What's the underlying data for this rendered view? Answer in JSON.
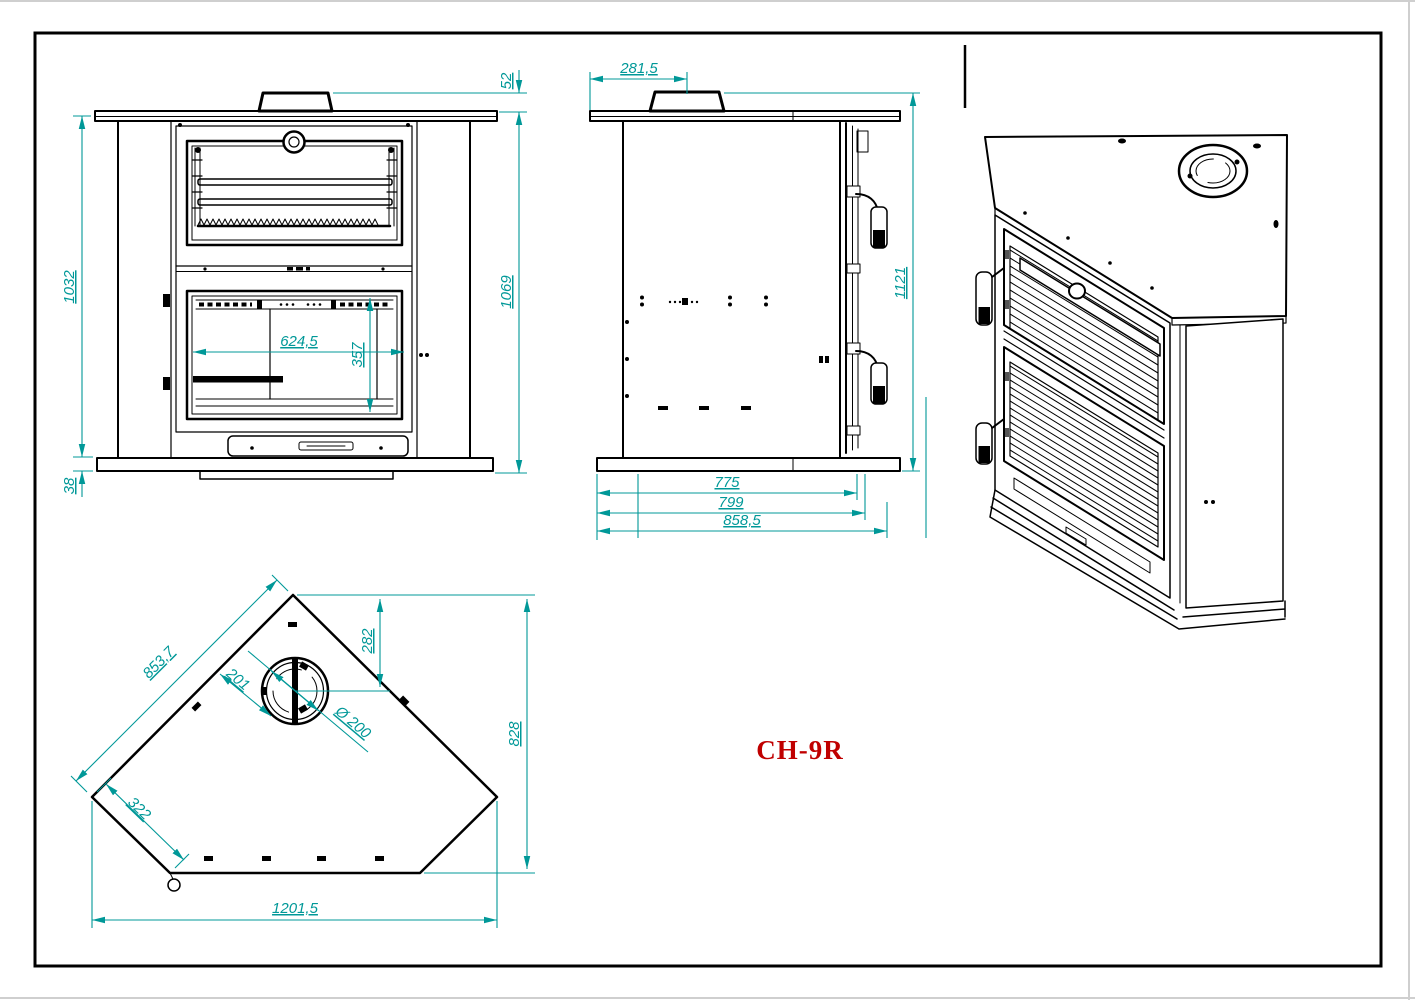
{
  "drawing": {
    "model_label": "CH-9R",
    "colors": {
      "dimension": "#009898",
      "line": "#000000",
      "title": "#c00000"
    },
    "views": {
      "front": {
        "dims": {
          "collar_height": "52",
          "body_height": "1032",
          "plinth_height": "38",
          "total_height": "1069",
          "firebox_width": "624,5",
          "firebox_height": "357"
        }
      },
      "side": {
        "dims": {
          "flue_center_offset": "281,5",
          "total_height": "1121",
          "depth_inner": "775",
          "depth_mid": "799",
          "depth_overall": "858,5"
        }
      },
      "plan": {
        "dims": {
          "front_edge": "853,7",
          "flue_center_depth": "282",
          "flue_edge_clearance": "201",
          "flue_diameter": "Ø 200",
          "side_edge": "322",
          "overall_depth": "828",
          "overall_width": "1201,5"
        }
      }
    }
  }
}
